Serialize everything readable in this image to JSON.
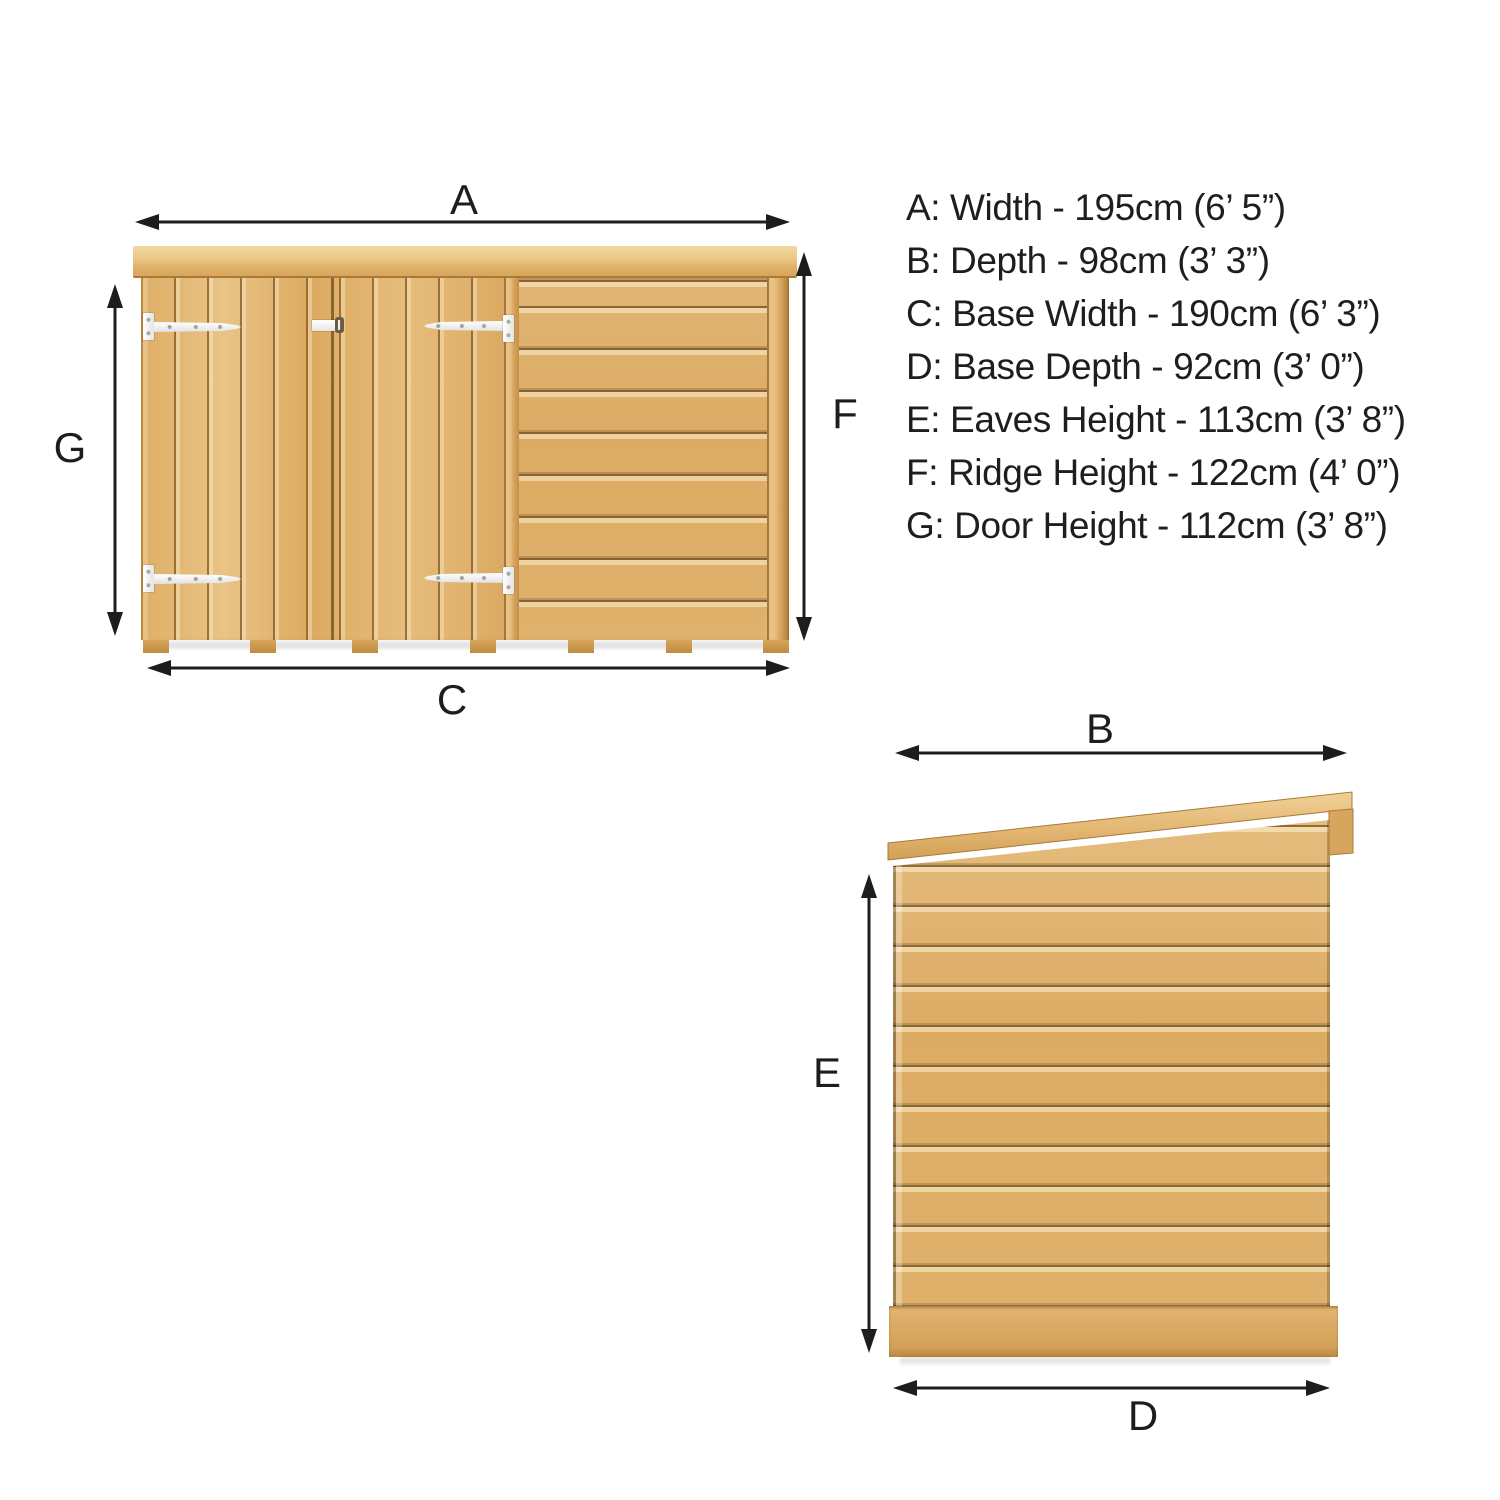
{
  "diagram": {
    "type": "product-dimension-diagram",
    "subject": "wooden pent-roof garden storage shed, two elevation views with dimension arrows",
    "views": {
      "front": {
        "name": "front-elevation",
        "dimension_markers": [
          "A",
          "G",
          "F",
          "C"
        ]
      },
      "side": {
        "name": "side-elevation",
        "dimension_markers": [
          "B",
          "E",
          "D"
        ]
      }
    }
  },
  "dimension_labels": {
    "A": "A",
    "B": "B",
    "C": "C",
    "D": "D",
    "E": "E",
    "F": "F",
    "G": "G"
  },
  "spec_list": {
    "items": [
      {
        "id": "A",
        "label": "Width",
        "value": "195cm (6’ 5”)",
        "text": "A: Width - 195cm (6’ 5”)"
      },
      {
        "id": "B",
        "label": "Depth",
        "value": "98cm (3’ 3”)",
        "text": "B: Depth - 98cm (3’ 3”)"
      },
      {
        "id": "C",
        "label": "Base Width",
        "value": "190cm (6’ 3”)",
        "text": "C: Base Width - 190cm (6’ 3”)"
      },
      {
        "id": "D",
        "label": "Base Depth",
        "value": "92cm (3’ 0”)",
        "text": "D: Base Depth - 92cm (3’ 0”)"
      },
      {
        "id": "E",
        "label": "Eaves Height",
        "value": "113cm (3’ 8”)",
        "text": "E: Eaves Height - 113cm (3’ 8”)"
      },
      {
        "id": "F",
        "label": "Ridge Height",
        "value": "122cm (4’ 0”)",
        "text": "F: Ridge Height - 122cm (4’ 0”)"
      },
      {
        "id": "G",
        "label": "Door Height",
        "value": "112cm (3’ 8”)",
        "text": "G: Door Height - 112cm (3’ 8”)"
      }
    ]
  },
  "colors": {
    "background": "#ffffff",
    "arrow_line": "#1d1d1d",
    "text": "#1e1e1e",
    "wood_light": "#eccd96",
    "wood_mid": "#dfae66",
    "wood_shadow": "#b5813c",
    "wood_groove": "#97702f",
    "hinge_white": "#f5f5f5"
  }
}
